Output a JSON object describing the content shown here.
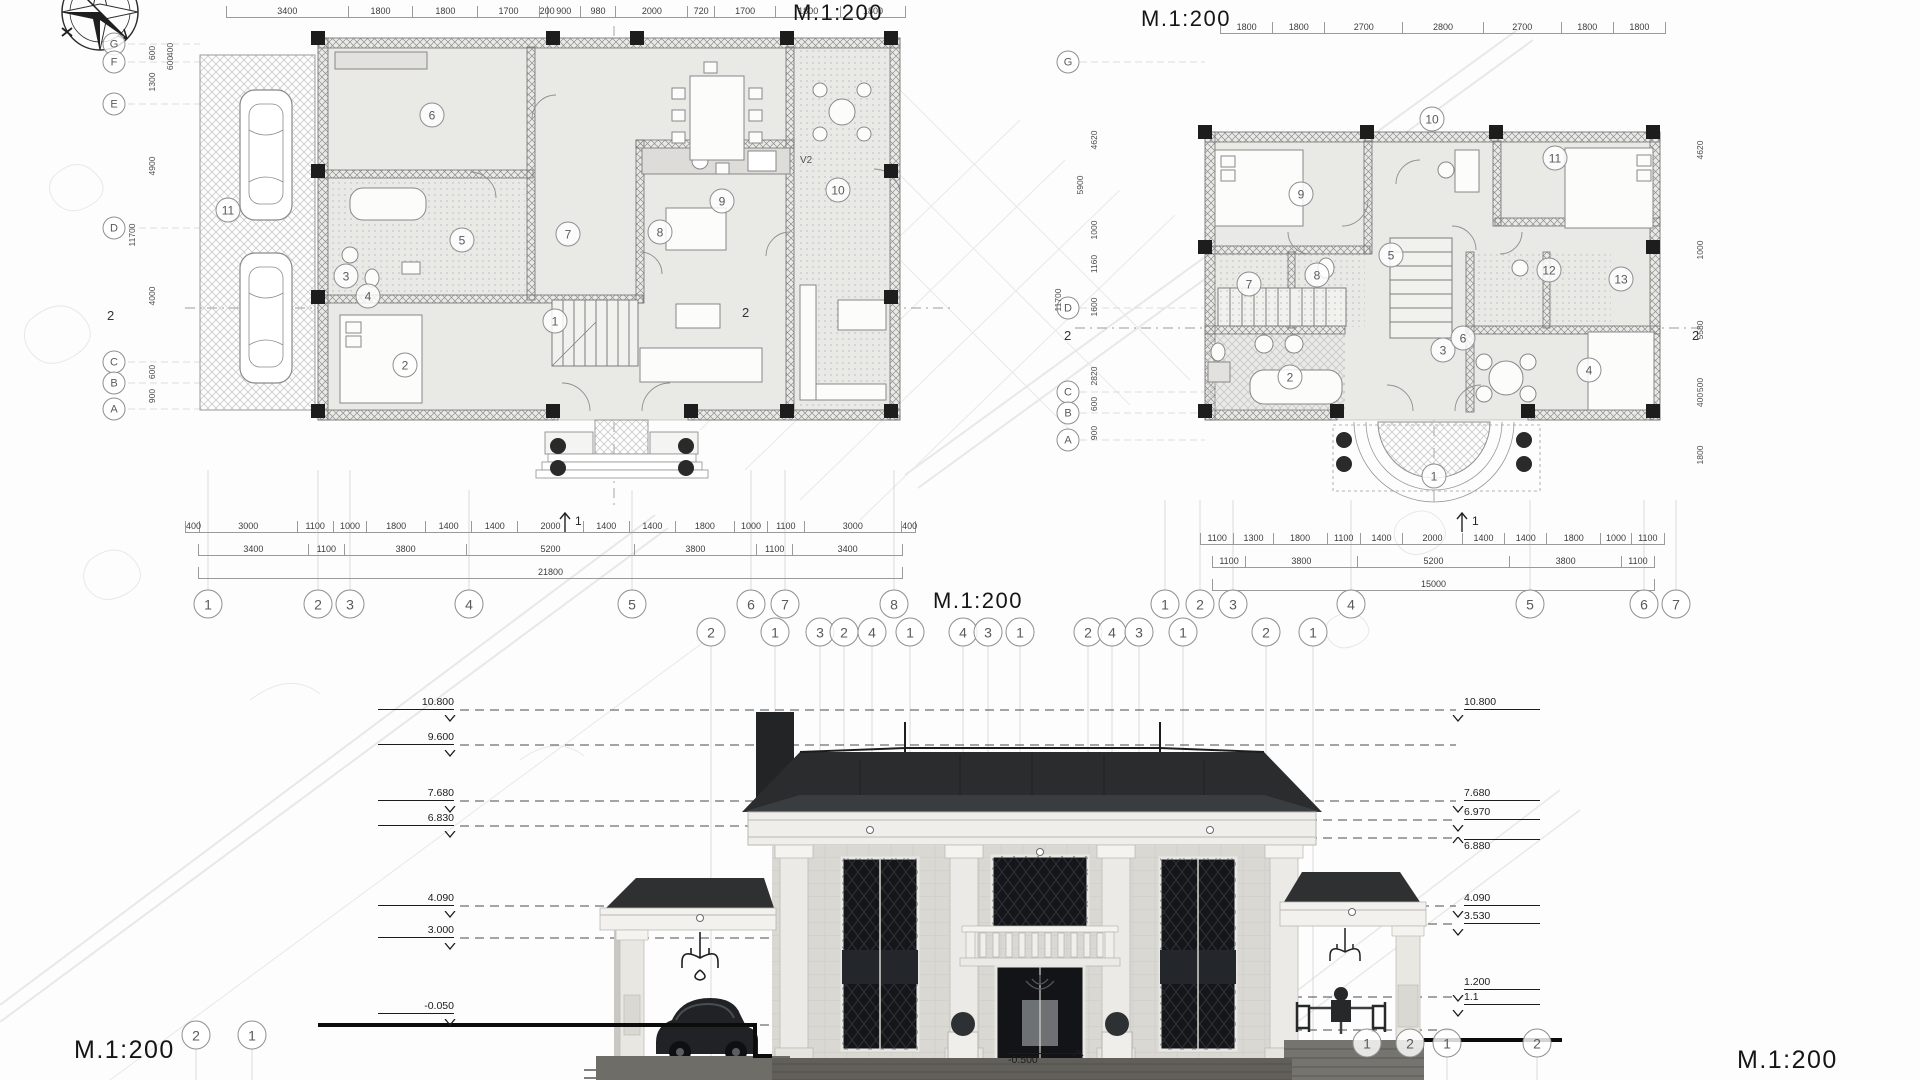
{
  "title_labels": {
    "plan1_scale": "M.1:200",
    "plan2_scale": "M.1:200",
    "elev_scale_center": "M.1:200",
    "elev_scale_left": "M.1:200",
    "elev_scale_right": "M.1:200"
  },
  "plan1": {
    "top_dims": [
      "3400",
      "1800",
      "1800",
      "1700",
      "200",
      "900",
      "980",
      "2000",
      "720",
      "1700",
      "1800",
      "1800"
    ],
    "bottom_dims_row1": [
      "400",
      "3000",
      "1100",
      "1000",
      "1800",
      "1400",
      "1400",
      "2000",
      "1400",
      "1400",
      "1800",
      "1000",
      "1100",
      "3000",
      "400"
    ],
    "bottom_dims_row2": [
      "3400",
      "1100",
      "3800",
      "5200",
      "3800",
      "1100",
      "3400"
    ],
    "total_dim": "21800",
    "left_dims": [
      "600",
      "1300",
      "4900",
      "4000",
      "600",
      "900"
    ],
    "left_inner_dims": [
      "400",
      "600"
    ],
    "left_total": "11700",
    "grid_letters": [
      "G",
      "F",
      "E",
      "D",
      "C",
      "B",
      "A"
    ],
    "grid_numbers": [
      "1",
      "2",
      "3",
      "4",
      "5",
      "6",
      "7",
      "8"
    ],
    "rooms": [
      "1",
      "2",
      "3",
      "4",
      "5",
      "6",
      "7",
      "8",
      "9",
      "10",
      "11"
    ],
    "vent_label": "V2",
    "section_bottom": "1",
    "section_side": "2"
  },
  "plan2": {
    "top_dims": [
      "1800",
      "1800",
      "2700",
      "2800",
      "2700",
      "1800",
      "1800"
    ],
    "bottom_dims_row1": [
      "1100",
      "1300",
      "1800",
      "1100",
      "1400",
      "2000",
      "1400",
      "1400",
      "1800",
      "1000",
      "1100"
    ],
    "bottom_dims_row2": [
      "1100",
      "3800",
      "5200",
      "3800",
      "1100"
    ],
    "total_dim": "15000",
    "left_dims": [
      "4620",
      "1000",
      "1160",
      "1600",
      "2820",
      "600",
      "900"
    ],
    "left_sub_total": "5900",
    "left_total": "11700",
    "right_dims": [
      "4620",
      "1000",
      "5580",
      "500",
      "400",
      "1800"
    ],
    "grid_letters": [
      "G",
      "D",
      "C",
      "B",
      "A"
    ],
    "grid_numbers": [
      "1",
      "2",
      "3",
      "4",
      "5",
      "6",
      "7"
    ],
    "rooms": [
      "1",
      "2",
      "3",
      "4",
      "5",
      "6",
      "7",
      "8",
      "9",
      "10",
      "11",
      "12",
      "13"
    ],
    "section_bottom": "1",
    "section_side": "2"
  },
  "elevation": {
    "axis_bubbles": [
      "2",
      "1",
      "3",
      "2",
      "4",
      "1",
      "4",
      "3",
      "1",
      "2",
      "4",
      "3",
      "1",
      "2",
      "1"
    ],
    "bottom_left_bubbles": [
      "2",
      "1"
    ],
    "bottom_right_bubbles": [
      "1",
      "2",
      "1",
      "2"
    ],
    "levels_left": [
      "10.800",
      "9.600",
      "7.680",
      "6.830",
      "4.090",
      "3.000"
    ],
    "level_ground": "-0.050",
    "level_basement": "-0.500",
    "levels_right": [
      "10.800",
      "7.680",
      "6.970",
      "6.880",
      "4.090",
      "3.530",
      "1.200",
      "1.1"
    ]
  }
}
